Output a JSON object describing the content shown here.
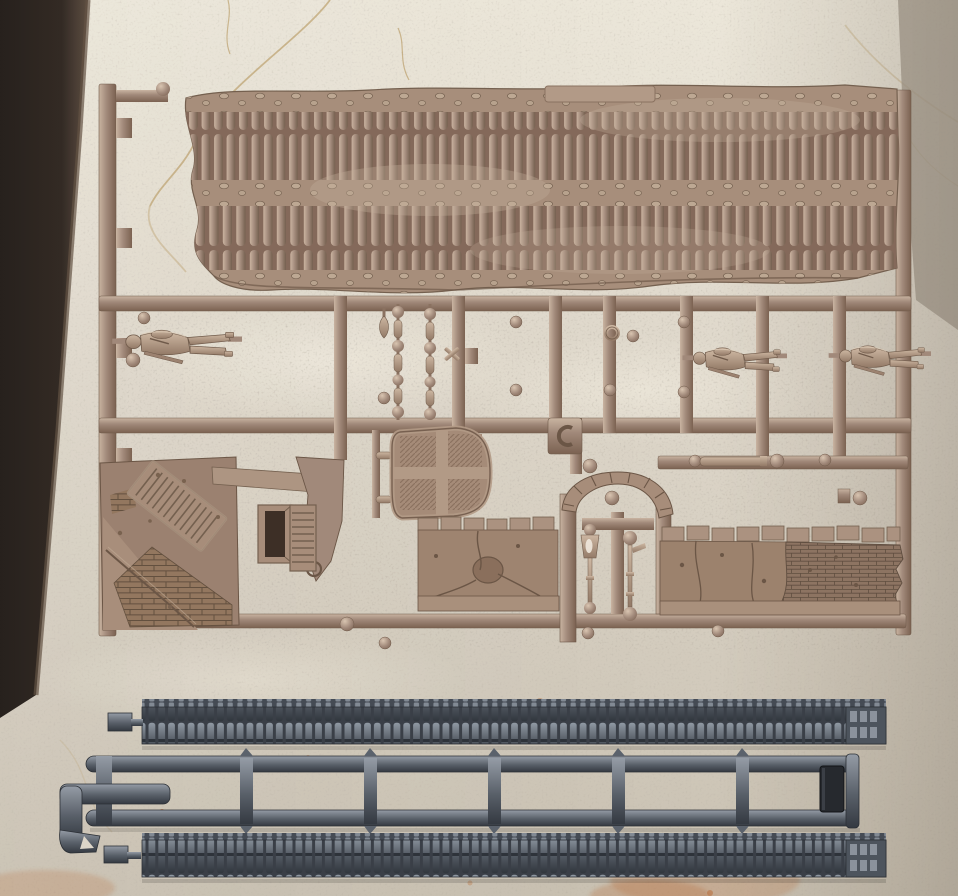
{
  "image_type": "photograph",
  "subject": "two plastic model-kit sprues (tan diorama/scenery sprue and dark grey track sprue) lying on a cream marble slab",
  "colors": {
    "marble": "#ddd6c9",
    "marble_light": "#ece7da",
    "marble_shade": "#c9c1b2",
    "vein": "#b08d4e",
    "table_edge_dark": "#2a211b",
    "tan_plastic": "#a1897a",
    "tan_highlight": "#c9b4a1",
    "tan_shadow": "#7b6251",
    "figure_plastic": "#b49b86",
    "grey_plastic": "#596069",
    "grey_highlight": "#959ca6",
    "grey_shadow": "#343941",
    "dark_connector": "#26292e",
    "rust_stain": "#b5622a",
    "door_opening_dark": "#3d2f26"
  },
  "objects": {
    "background": {
      "label": "cream marble slab",
      "details": [
        "golden crack veins",
        "dark table edge on the left",
        "rust stains near the bottom",
        "grey shaded band top right"
      ]
    },
    "tan_sprue": {
      "label": "tan scenery sprue",
      "parts": [
        "large textured ground panel with two bands of log/sandbag ribs",
        "raised rectangular tab on panel top edge",
        "soldier figure lying in frame (left)",
        "soldier figure lying in frame (middle right)",
        "soldier figure lying in frame (far right)",
        "two bead chains of balls and capsules",
        "teardrop peg",
        "ruined house corner with slatted shutter and brick corner",
        "door frame with dark opening",
        "louvered shutter piece",
        "broken wall fragment with curl",
        "round hatch with cross ribs and diagonal hatching",
        "cracked wall section with coping stones and crater",
        "stone archway with voussoirs",
        "street lamp with conical shade",
        "street lamp with ball top",
        "damaged wall section with exposed bricks",
        "handle bars and sprue-gate balls"
      ]
    },
    "grey_sprue": {
      "label": "dark grey track sprue",
      "parts": [
        "upper track length with link teeth",
        "lower track length with link teeth",
        "ladder shaped runner frame",
        "hook shaped handle on left end",
        "small dark end connector part"
      ]
    }
  }
}
